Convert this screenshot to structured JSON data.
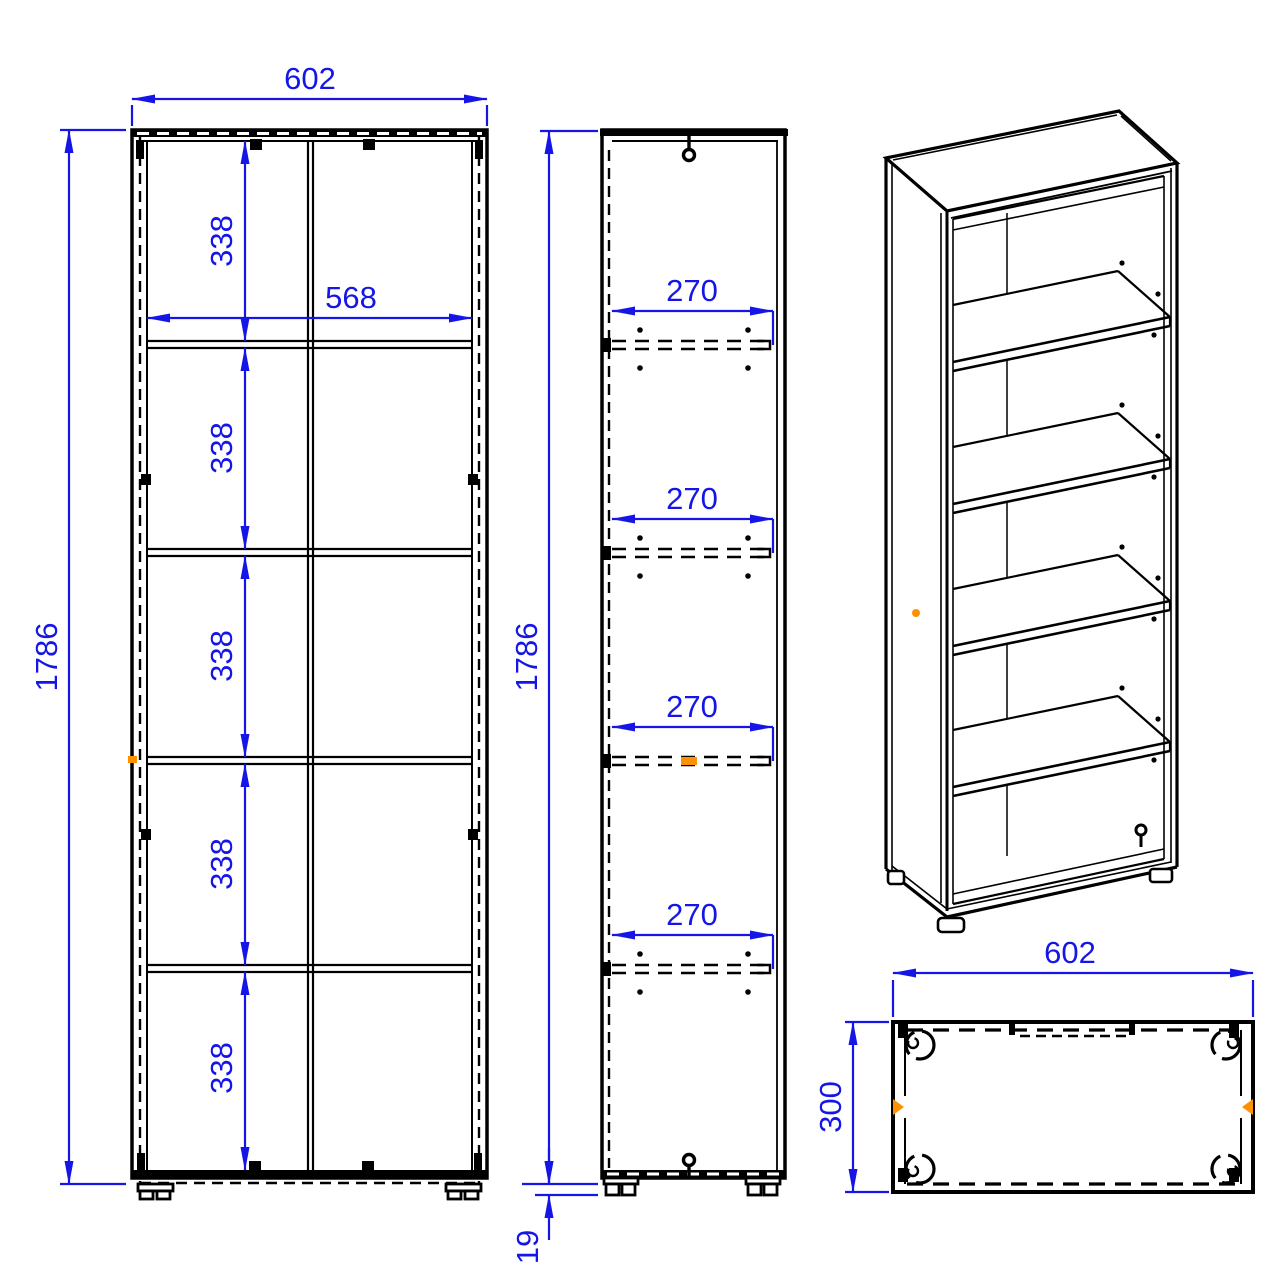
{
  "drawing": {
    "kind": "furniture-technical-drawing",
    "colors": {
      "dimension_blue": "#1515e8",
      "highlight_orange": "#ff9100",
      "line_black": "#000000",
      "background": "#ffffff"
    },
    "front_view": {
      "width_label": "602",
      "height_label": "1786",
      "inner_width_label": "568",
      "spacing_labels": [
        "338",
        "338",
        "338",
        "338",
        "338"
      ]
    },
    "side_view": {
      "height_label": "1786",
      "depth_labels": [
        "270",
        "270",
        "270",
        "270"
      ],
      "plinth_label": "19"
    },
    "top_view": {
      "width_label": "602",
      "depth_label": "300"
    }
  }
}
